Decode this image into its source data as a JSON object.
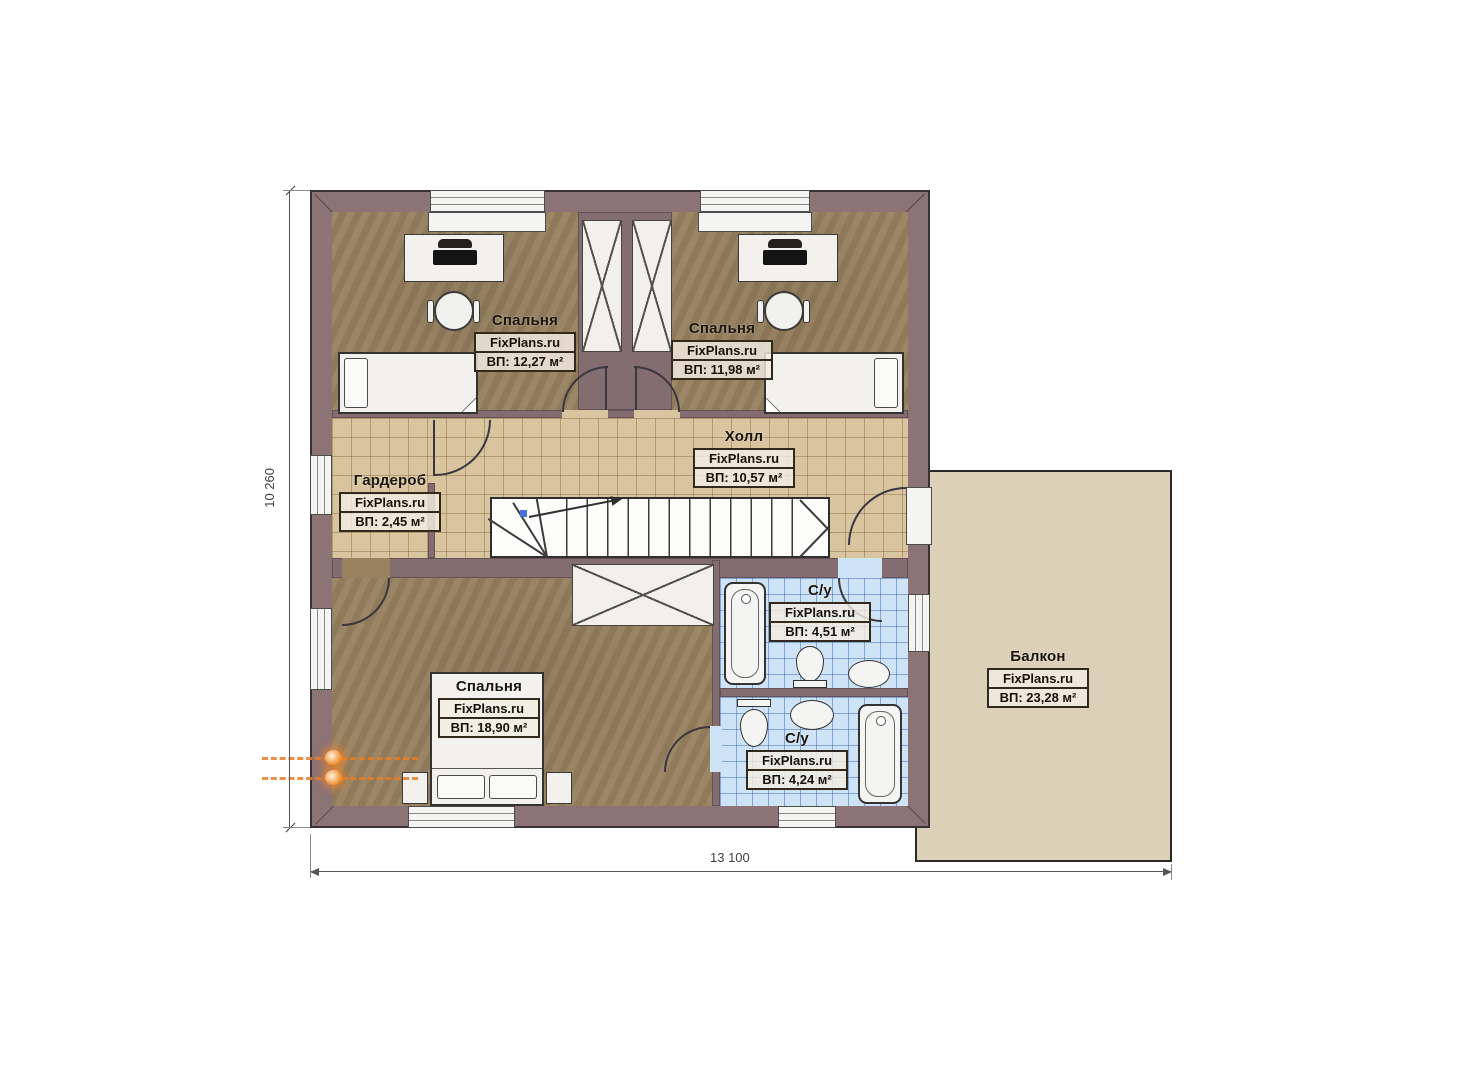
{
  "watermark": "FixPlans.ru",
  "rooms": [
    {
      "id": "bedroom-top-left",
      "name": "Спальня",
      "area": "ВП: 12,27 м²"
    },
    {
      "id": "bedroom-top-right",
      "name": "Спальня",
      "area": "ВП: 11,98 м²"
    },
    {
      "id": "hall",
      "name": "Холл",
      "area": "ВП: 10,57 м²"
    },
    {
      "id": "wardrobe",
      "name": "Гардероб",
      "area": "ВП: 2,45 м²"
    },
    {
      "id": "bedroom-master",
      "name": "Спальня",
      "area": "ВП: 18,90 м²"
    },
    {
      "id": "bathroom-upper",
      "name": "С/у",
      "area": "ВП: 4,51 м²"
    },
    {
      "id": "bathroom-lower",
      "name": "С/у",
      "area": "ВП: 4,24 м²"
    },
    {
      "id": "balcony",
      "name": "Балкон",
      "area": "ВП: 23,28 м²"
    }
  ],
  "dimensions": {
    "overall_width": "13 100",
    "overall_height": "10 260"
  },
  "colors": {
    "wall": "#8b7376",
    "bedroom_floor": "#97815f",
    "hall_tile": "#d8c5a0",
    "bath_tile": "#cfe3f6",
    "balcony_floor": "#dcd0b9",
    "flue_accent": "#f08a28"
  }
}
